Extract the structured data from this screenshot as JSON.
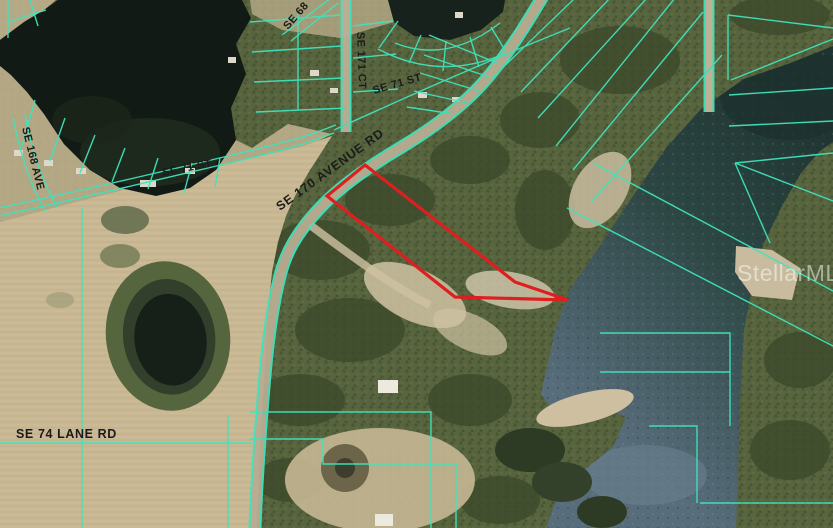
{
  "map": {
    "type": "aerial-parcel-map",
    "labels": {
      "avenue_170": "SE 170 AVENUE RD",
      "lane_74": "SE 74 LANE RD",
      "st_71_west": "SE 71 ST",
      "st_71_east": "SE 71 ST",
      "ct_171": "SE 171 CT",
      "ave_168": "SE 168 AVE",
      "st_68": "SE 68"
    },
    "watermark": "StellarMLS",
    "colors": {
      "parcel_line": "#3fe3bc",
      "subject_boundary": "#df1f1f",
      "label_text": "#1b1b1b",
      "watermark_text": "#ffffff"
    }
  }
}
